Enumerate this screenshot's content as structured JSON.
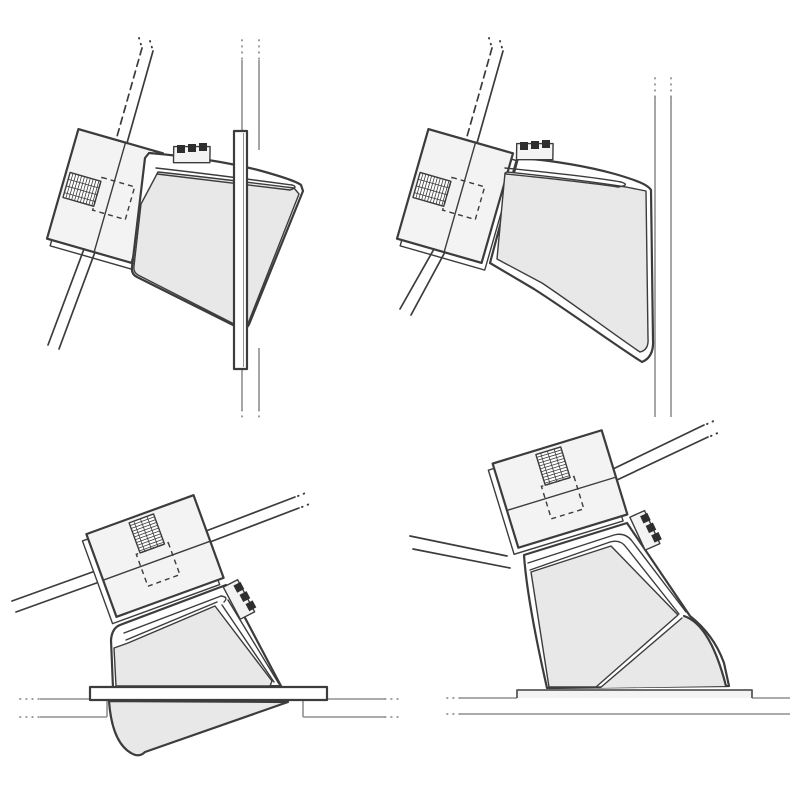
{
  "figure": {
    "type": "technical-line-diagram",
    "panel_count": 4,
    "description": "Four-panel monochrome installation diagram of a clamp-bracket assembly with knurled bolt, ratchet detail and shaded housing shown mounted to vertical and horizontal surfaces"
  },
  "colors": {
    "background": "#ffffff",
    "outline": "#3c3c3c",
    "context_line": "#909090",
    "mid_line": "#5a5a5a",
    "plate_fill": "#f3f3f3",
    "shade_fill": "#e8e8e8",
    "white_fill": "#ffffff",
    "teeth_fill": "#2e2e2e"
  },
  "panels": [
    {
      "id": "top-left",
      "label": "clamp assembly on vertical surface with backing board"
    },
    {
      "id": "top-right",
      "label": "clamp assembly flush against vertical surface"
    },
    {
      "id": "bottom-left",
      "label": "clamp assembly through horizontal surface with top plate, housing protruding below"
    },
    {
      "id": "bottom-right",
      "label": "clamp assembly on horizontal surface with tapered wedge pad"
    }
  ]
}
